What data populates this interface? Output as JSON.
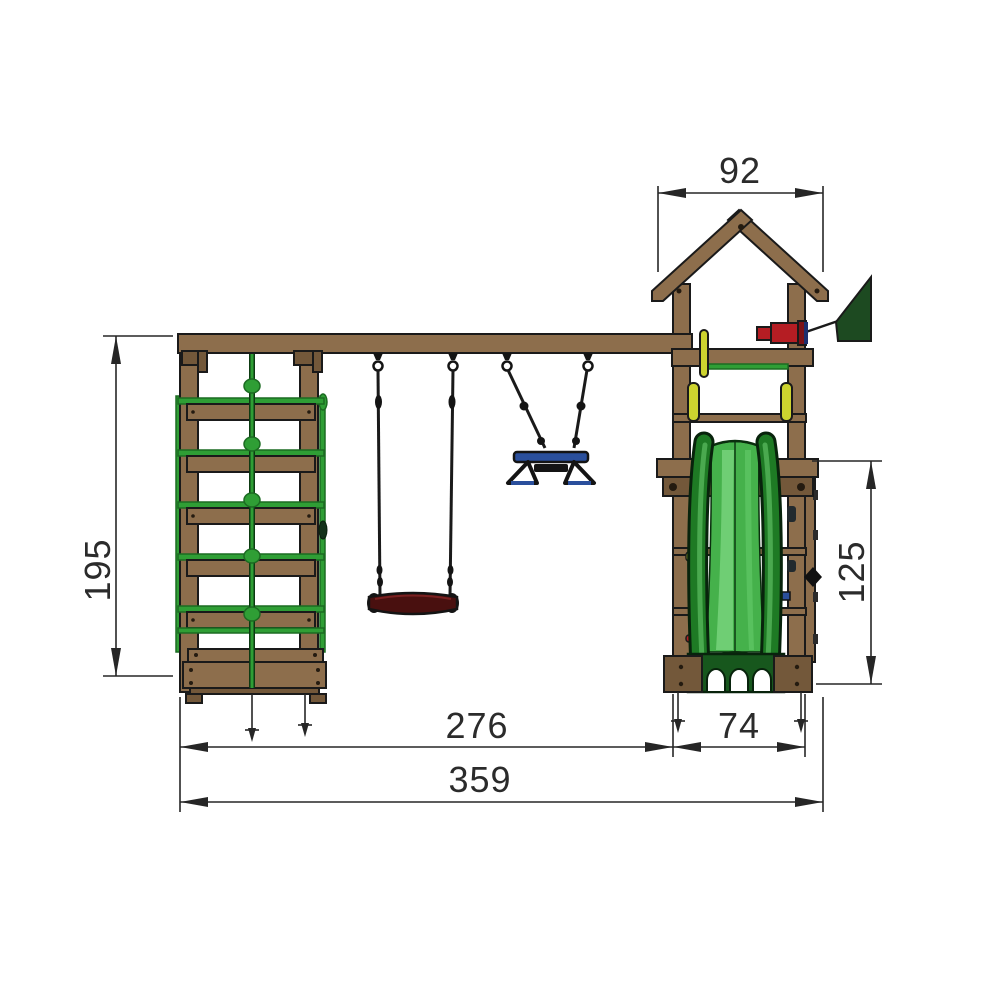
{
  "diagram": {
    "type": "playground-set dimension drawing, front view",
    "dimensions": {
      "roof_width": "92",
      "frame_height": "195",
      "platform_height": "125",
      "swing_section_width": "276",
      "tower_width": "74",
      "total_width": "359"
    }
  },
  "colors": {
    "background": "#ffffff",
    "line": "#1a1a1a",
    "dim_text": "#2b2b2b",
    "wood": "#8d6e4c",
    "wood_dark": "#73583a",
    "green": "#2f9e35",
    "green_dark": "#1c6b22",
    "slide_rail": "#1e7a24",
    "slide_channel": "#45b14b",
    "slide_highlight": "#7ed881",
    "flag_green": "#1d4a21",
    "blue": "#2a4f9c",
    "red": "#b51d23",
    "seat_red": "#49100f",
    "yellow": "#cdd32f"
  }
}
